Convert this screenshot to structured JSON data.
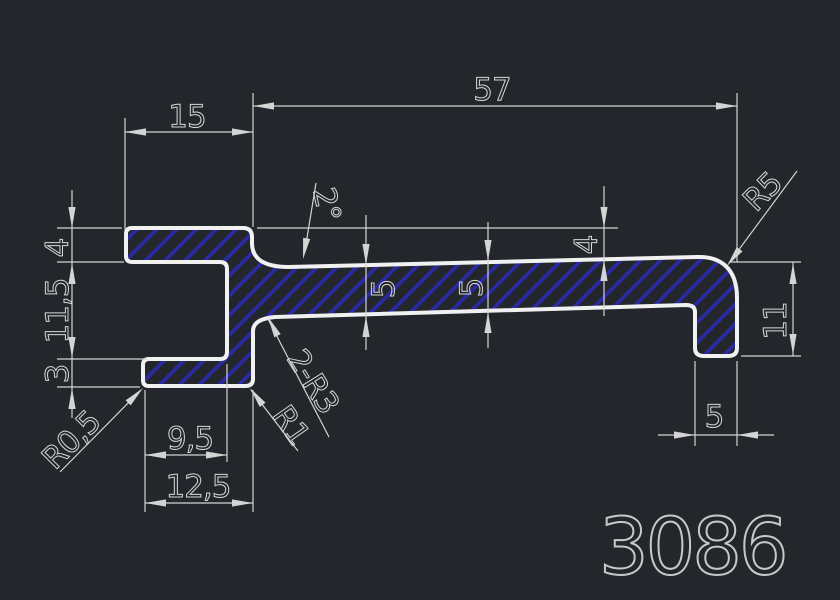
{
  "drawing": {
    "part_number": "3086",
    "dimensions": {
      "total_width": "57",
      "top_flange_width": "15",
      "top_flange_thickness": "4",
      "left_inner_height": "11,5",
      "bottom_flange_thickness": "3",
      "corner_radius_small": "R0,5",
      "bottom_inner_width": "9,5",
      "bottom_flange_width": "12,5",
      "web_angle": "2°",
      "web_thickness_left": "5",
      "web_thickness_right": "5",
      "web_offset_right": "4",
      "top_right_radius": "R5",
      "right_leg_height": "11",
      "right_leg_width": "5",
      "transition_radius": "2-R3",
      "flange_corner_radius": "R1"
    },
    "colors": {
      "background": "#23262b",
      "profile": "#f1f1f1",
      "dimline": "#d4d4d4",
      "text": "#d6d6d6",
      "hatch": "#2a2aa5",
      "partnum": "#c8c8c8"
    }
  }
}
